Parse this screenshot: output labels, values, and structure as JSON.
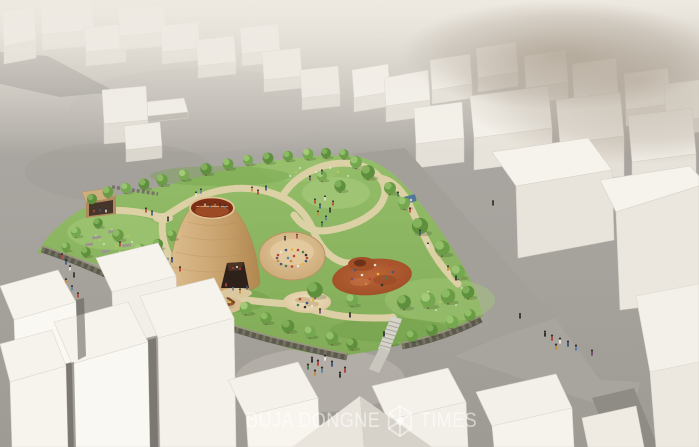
{
  "watermark": {
    "left": "BUJA DONGNE",
    "right": "TIMES",
    "icon": "hexagon-gem"
  },
  "palette": {
    "haze": "#e9e5dc",
    "hillside_gray": "#a7a39e",
    "distant_haze_brown": "#97897a",
    "building_white": "#f5f2eb",
    "building_shadow": "#dcd7ce",
    "park_green": "#8cb65f",
    "meadow_light_green": "#a6ca79",
    "tree_green": "#679a43",
    "path_tan": "#dfd1a8",
    "cone_tan": "#c9a271",
    "crater_red_brown": "#8c3a1e",
    "dig_pit_soil": "#b05a31",
    "sand_pit": "#ead9b5",
    "stone_wall": "#5c5a4e",
    "watermark_text": "#ffffff"
  }
}
